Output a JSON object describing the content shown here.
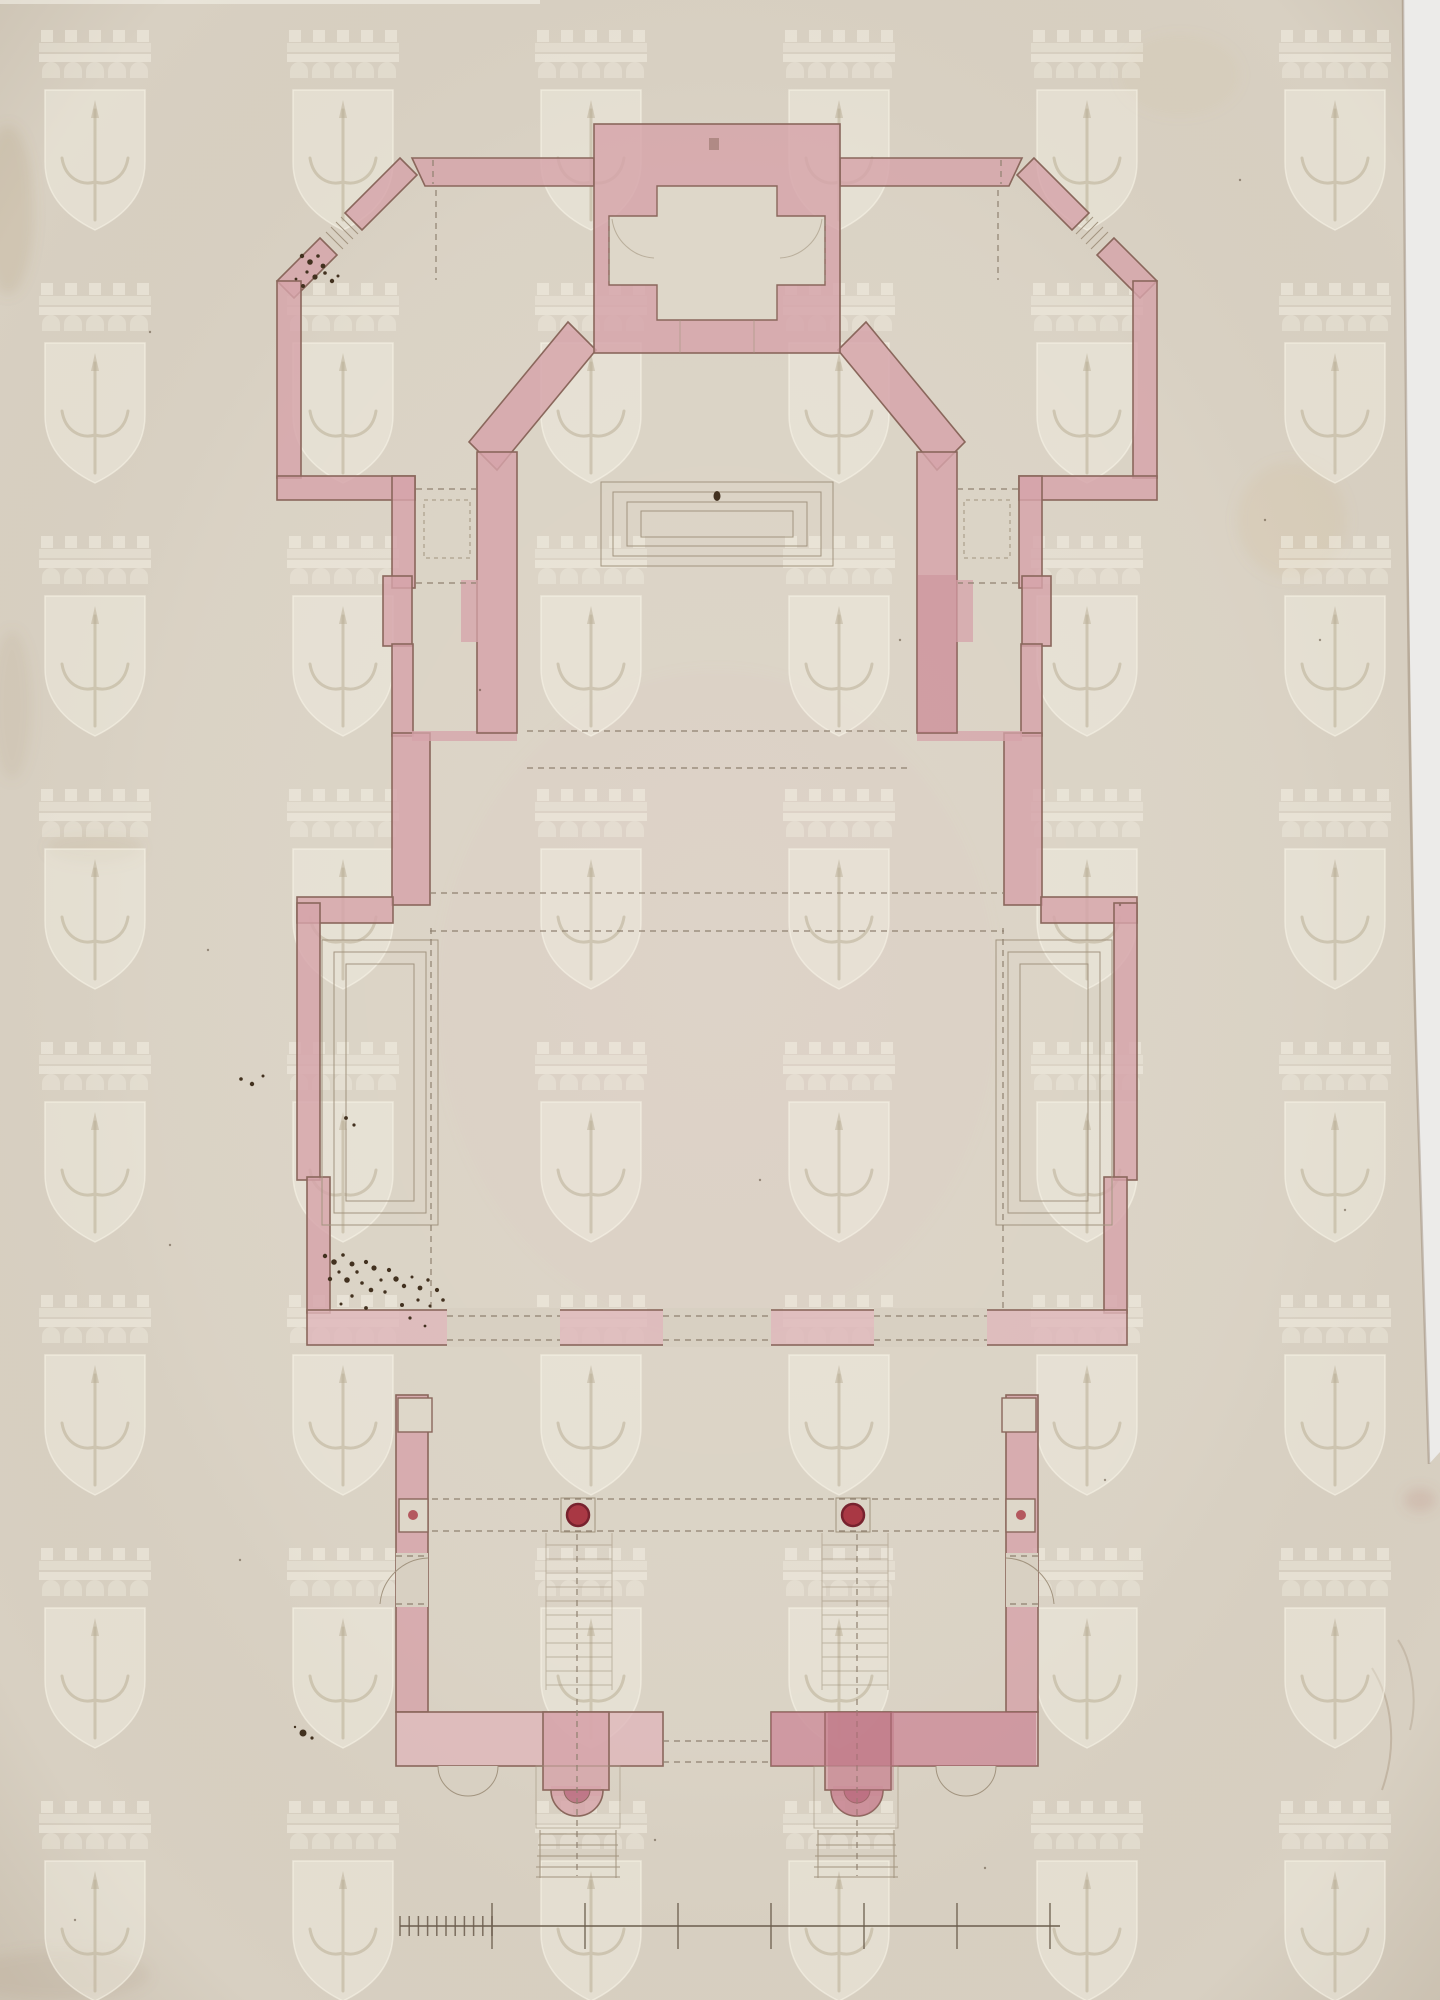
{
  "document": {
    "type": "scanned architectural drawing",
    "description": "Ground-floor plan of a symmetrical building rendered in pink watercolour wash on aged cream paper; pencil construction lines, two red columns, scale bar at bottom; repeating shield watermark; no inscriptions visible",
    "visible_text": "",
    "orientation": "portrait"
  },
  "palette": {
    "paper": "#d8d0c2",
    "paper-l": "#ded7c9",
    "pink": "#d6a3aa",
    "pink-l": "#dfb6ba",
    "pink-d": "#c9909b",
    "deep": "#b96a7d",
    "outline": "#8a675c",
    "pencil": "#a2947f",
    "pencil-dk": "#8f8170",
    "ink": "#42311f",
    "col-red": "#a93844",
    "col-ring": "#77222e",
    "scan": "#ecebe9"
  },
  "watermark": {
    "icon": "shield-with-fleur-staff-under-castle-crown-icon",
    "columns_x": [
      95,
      343,
      591,
      839,
      1087,
      1335
    ],
    "rows_y": [
      30,
      283,
      536,
      789,
      1042,
      1295,
      1548,
      1801
    ]
  },
  "plan": {
    "columns": [
      {
        "x": 578,
        "y": 1515
      },
      {
        "x": 853,
        "y": 1515
      }
    ],
    "column_radius": 11
  },
  "scale_bar": {
    "x_start": 400,
    "x_end": 1060,
    "y": 1926,
    "minor_end": 492,
    "minor_count": 11,
    "minor_h": 20,
    "major_xs": [
      492,
      585,
      678,
      771,
      864,
      957,
      1050
    ],
    "major_h": 46
  },
  "ink_specks": {
    "clusters": [
      {
        "name": "pavilion-door-spatter",
        "points": [
          [
            302,
            256,
            2.2
          ],
          [
            310,
            262,
            2.8
          ],
          [
            318,
            256,
            1.8
          ],
          [
            323,
            266,
            2.4
          ],
          [
            307,
            272,
            1.6
          ],
          [
            315,
            277,
            2.6
          ],
          [
            325,
            273,
            1.8
          ],
          [
            332,
            281,
            2.2
          ],
          [
            338,
            276,
            1.5
          ],
          [
            303,
            286,
            2.0
          ],
          [
            296,
            279,
            1.4
          ]
        ]
      },
      {
        "name": "south-west-bay-spatter",
        "points": [
          [
            325,
            1256,
            2.2
          ],
          [
            334,
            1262,
            2.8
          ],
          [
            343,
            1255,
            1.8
          ],
          [
            352,
            1264,
            2.5
          ],
          [
            339,
            1272,
            1.6
          ],
          [
            330,
            1279,
            2.2
          ],
          [
            347,
            1280,
            2.8
          ],
          [
            357,
            1272,
            1.7
          ],
          [
            366,
            1262,
            2.1
          ],
          [
            374,
            1268,
            2.6
          ],
          [
            362,
            1283,
            1.8
          ],
          [
            371,
            1290,
            2.3
          ],
          [
            381,
            1280,
            1.6
          ],
          [
            389,
            1270,
            2.1
          ],
          [
            396,
            1279,
            2.7
          ],
          [
            385,
            1292,
            1.7
          ],
          [
            404,
            1286,
            2.2
          ],
          [
            412,
            1277,
            1.5
          ],
          [
            420,
            1288,
            2.4
          ],
          [
            428,
            1280,
            1.7
          ],
          [
            437,
            1290,
            2.1
          ],
          [
            418,
            1300,
            1.6
          ],
          [
            402,
            1305,
            2.0
          ],
          [
            430,
            1306,
            1.5
          ],
          [
            443,
            1300,
            1.8
          ],
          [
            352,
            1296,
            1.7
          ],
          [
            341,
            1304,
            1.5
          ],
          [
            366,
            1308,
            1.9
          ],
          [
            410,
            1318,
            1.6
          ],
          [
            425,
            1326,
            1.4
          ]
        ]
      },
      {
        "name": "left-margin-dots",
        "points": [
          [
            241,
            1079,
            1.8
          ],
          [
            252,
            1084,
            2.2
          ],
          [
            263,
            1076,
            1.5
          ],
          [
            346,
            1118,
            1.9
          ],
          [
            354,
            1125,
            1.6
          ]
        ]
      },
      {
        "name": "bottom-left-blot",
        "points": [
          [
            303,
            1733,
            3.5
          ],
          [
            312,
            1738,
            1.6
          ],
          [
            295,
            1727,
            1.2
          ]
        ]
      }
    ],
    "speckles": [
      [
        150,
        332
      ],
      [
        1240,
        180
      ],
      [
        1265,
        520
      ],
      [
        900,
        640
      ],
      [
        1120,
        905
      ],
      [
        480,
        690
      ],
      [
        208,
        950
      ],
      [
        1345,
        1210
      ],
      [
        760,
        1180
      ],
      [
        240,
        1560
      ],
      [
        1105,
        1480
      ],
      [
        655,
        1840
      ],
      [
        985,
        1868
      ],
      [
        75,
        1920
      ],
      [
        1320,
        640
      ],
      [
        170,
        1245
      ]
    ]
  }
}
